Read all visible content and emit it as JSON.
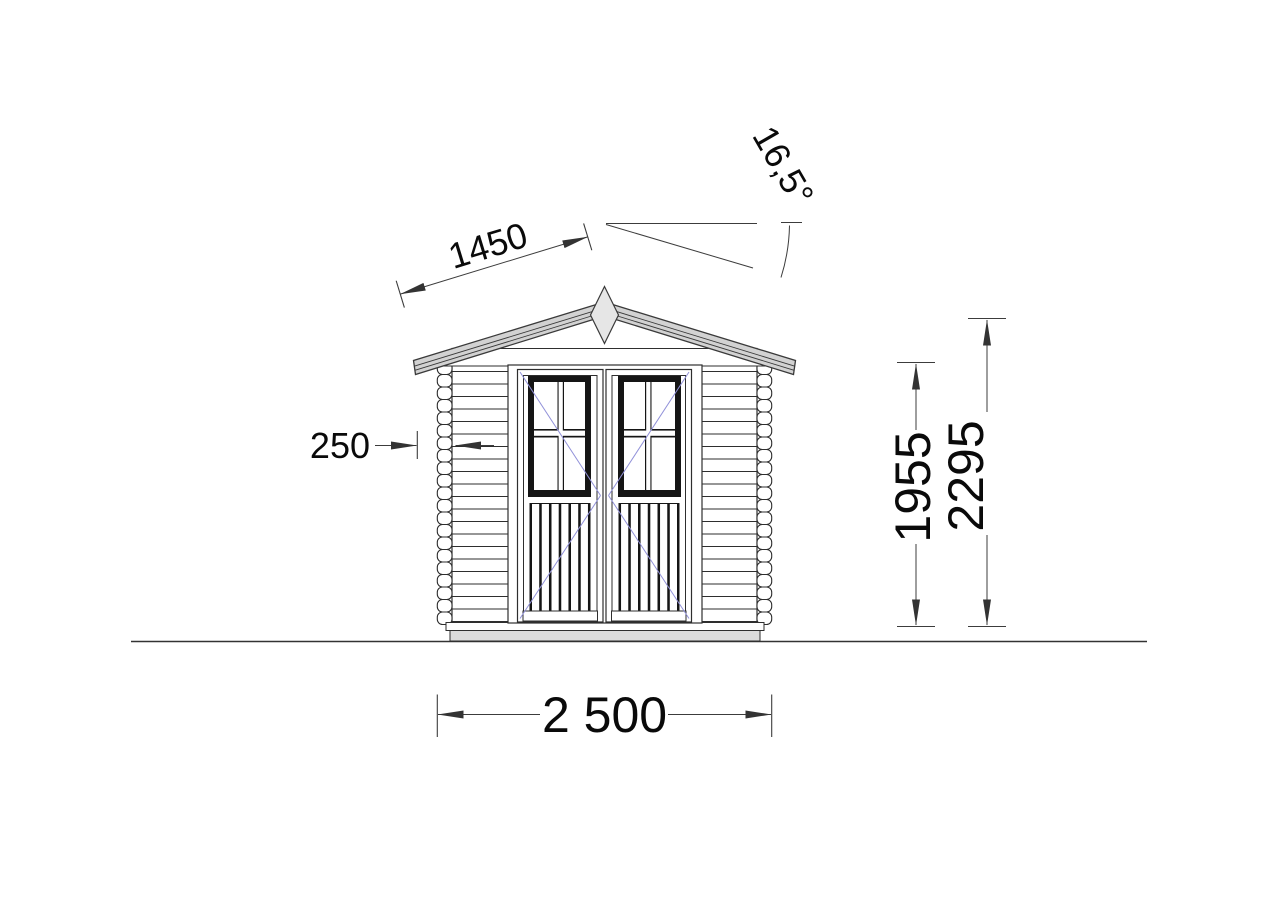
{
  "drawing": {
    "dimensions": {
      "slope_length": "1450",
      "roof_angle": "16,5°",
      "overhang": "250",
      "wall_height": "1955",
      "ridge_height": "2295",
      "total_width": "2 500"
    },
    "colors": {
      "line": "#2e2e2e",
      "dim_line": "#3c3c3c",
      "text": "#0a0a0a",
      "roof_fill": "#d2d2d2",
      "finial_fill": "#e6e6e6",
      "base_fill": "#dcdcdc",
      "door_dark": "#151515",
      "swing_line": "#9191d9",
      "background": "#ffffff"
    }
  }
}
